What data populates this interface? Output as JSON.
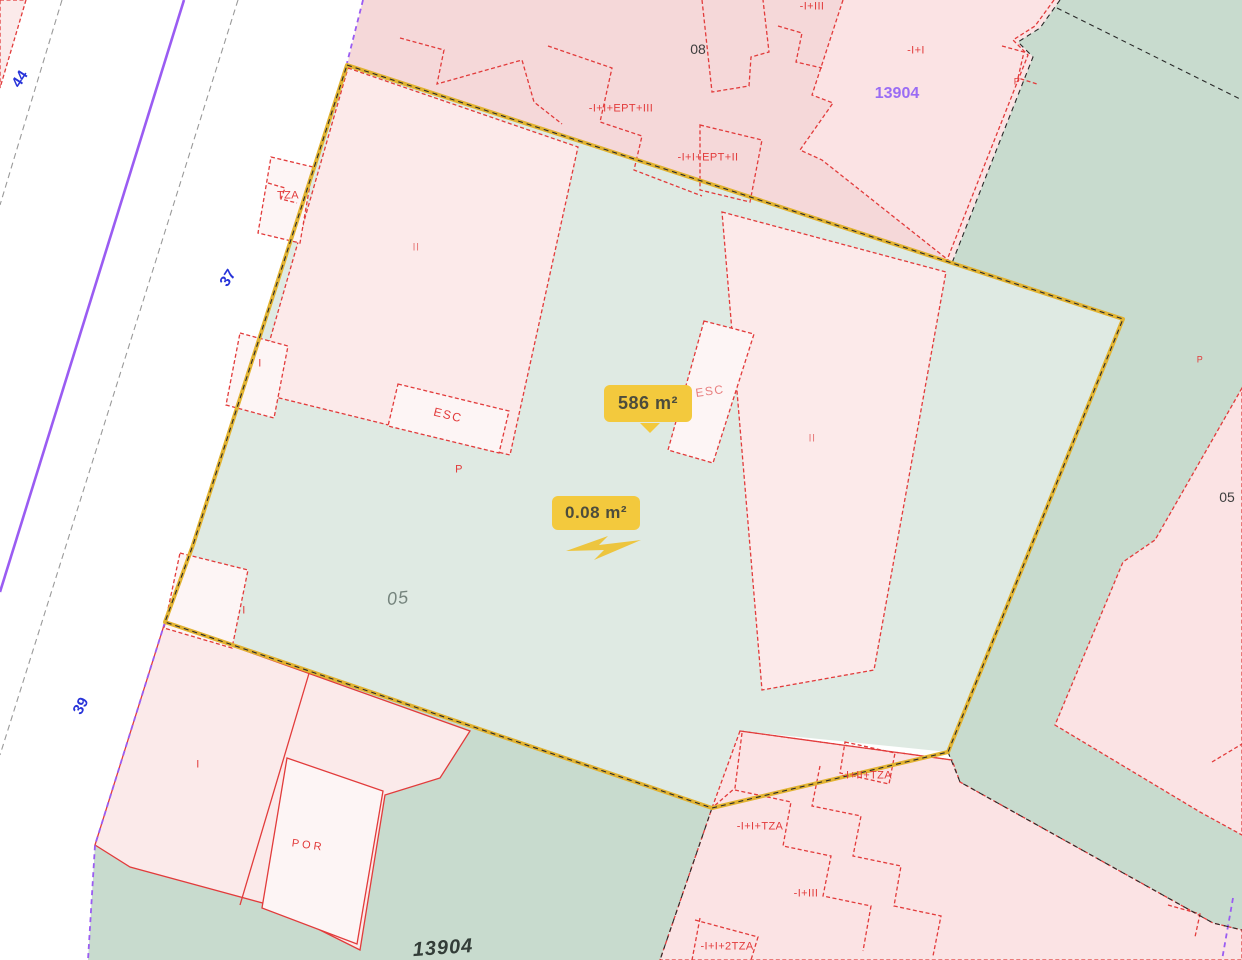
{
  "tooltips": {
    "main": "586 m²",
    "small": "0.08 m²"
  },
  "street_numbers": {
    "n44": "44",
    "n37": "37",
    "n39": "39"
  },
  "parcel_refs": {
    "p08": "08",
    "p05_center": "05",
    "p05_right": "05",
    "p13904_top": "13904",
    "p13904_bottom": "13904"
  },
  "building_labels": {
    "ept3": "-I+I+EPT+III",
    "ept2": "-I+I+EPT+II",
    "i3_top": "-I+III",
    "i1_top": "-I+I",
    "p_topright": "P",
    "tza": "TZA",
    "ii_left": "II",
    "i_left": "I",
    "esc_left": "ESC",
    "p_left": "P",
    "esc_right": "ESC",
    "ii_right": "II",
    "i_mid": "I",
    "i_bottom": "I",
    "por": "POR",
    "i2tza": "-I+II+TZA",
    "i1tza": "-I+I+TZA",
    "i3_bottom": "-I+III",
    "i12tza": "-I+I+2TZA",
    "p_right": "P"
  },
  "colors": {
    "selection_outline": "#e2b331",
    "tooltip_bg": "#f3c93d",
    "parcel_selected_fill": "#dfeae3",
    "parcel_green_fill": "#c8dbce",
    "parcel_pink_fill": "#f5d8d9",
    "building_outline": "#e23b3b",
    "street_number": "#2733d9",
    "street_line_purple": "#9a5cf2",
    "parcel_ref_purple": "#9a6cf4"
  }
}
